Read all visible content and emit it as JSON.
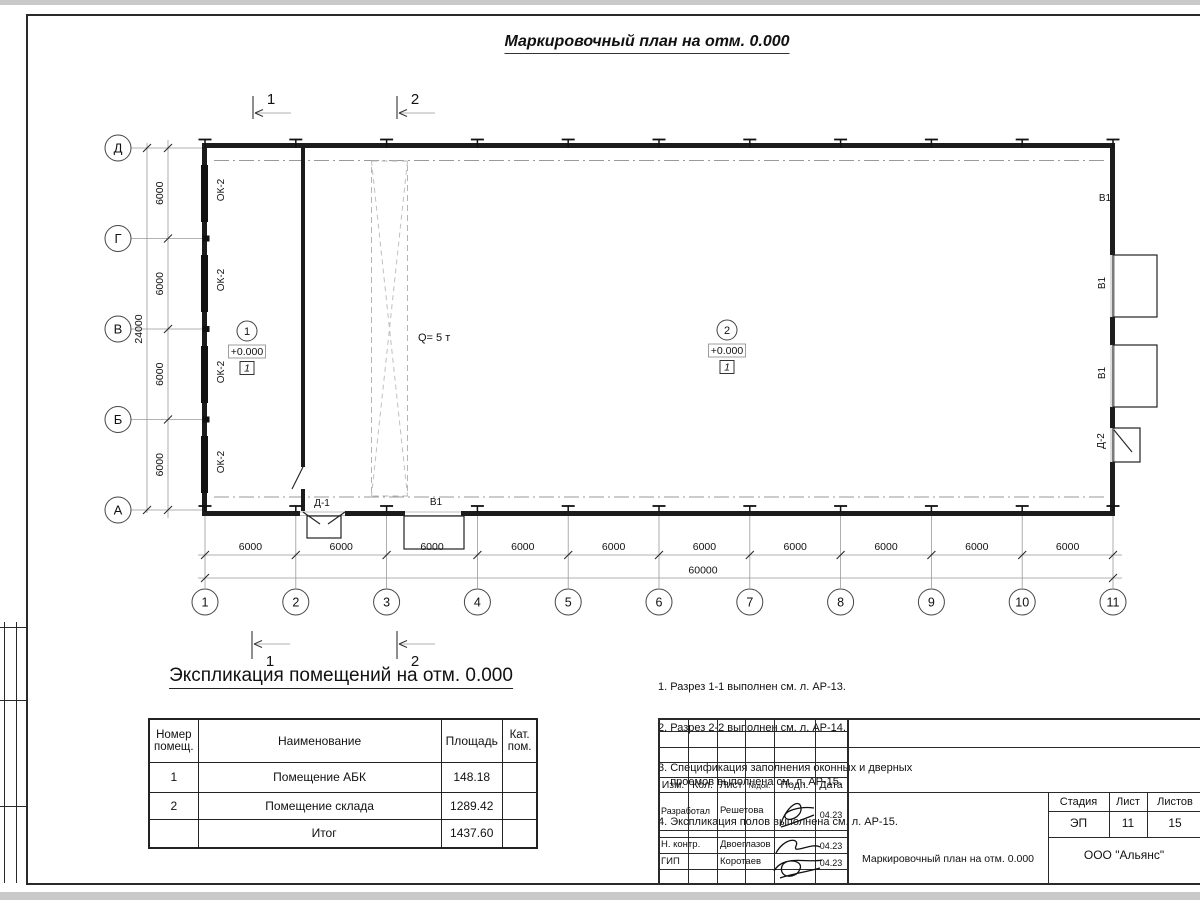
{
  "page": {
    "title": "Маркировочный план на отм. 0.000"
  },
  "plan": {
    "col_axes": [
      "1",
      "2",
      "3",
      "4",
      "5",
      "6",
      "7",
      "8",
      "9",
      "10",
      "11"
    ],
    "row_axes": [
      "Д",
      "Г",
      "В",
      "Б",
      "А"
    ],
    "bay_dim": "6000",
    "total_width": "60000",
    "total_height": "24000",
    "section_mark_1": "1",
    "section_mark_2": "2",
    "window_label": "ОК-2",
    "gate_label": "В1",
    "door1_label": "Д-1",
    "door2_label": "Д-2",
    "crane_label": "Q= 5 т",
    "room1": {
      "number": "1",
      "elevation": "+0.000",
      "floor_type": "1"
    },
    "room2": {
      "number": "2",
      "elevation": "+0.000",
      "floor_type": "1"
    }
  },
  "schedule": {
    "title": "Экспликация помещений на отм. 0.000",
    "headers": [
      "Номер помещ.",
      "Наименование",
      "Площадь",
      "Кат. пом."
    ],
    "rows": [
      [
        "1",
        "Помещение АБК",
        "148.18",
        ""
      ],
      [
        "2",
        "Помещение склада",
        "1289.42",
        ""
      ],
      [
        "",
        "Итог",
        "1437.60",
        ""
      ]
    ]
  },
  "notes": {
    "items": [
      "1. Разрез 1-1 выполнен см. л. АР-13.",
      "2. Разрез 2-2 выполнен см. л. АР-14.",
      "3. Спецификация заполнения оконных и дверных\n    проемов выполнена см. л. АР-15.",
      "4. Экспликация полов выполнена см. л. АР-15."
    ]
  },
  "titleblock": {
    "header_cols": [
      "Изм.",
      "Кол.",
      "Лист",
      "№док.",
      "Подп.",
      "Дата"
    ],
    "rows": [
      {
        "role": "Разработал",
        "name": "Решетова",
        "date": "04.23"
      },
      {
        "role": "Н. контр.",
        "name": "Двоеглазов",
        "date": "04.23"
      },
      {
        "role": "ГИП",
        "name": "Коротаев",
        "date": "04.23"
      }
    ],
    "stage_label": "Стадия",
    "sheet_label": "Лист",
    "sheets_label": "Листов",
    "stage": "ЭП",
    "sheet": "11",
    "sheets": "15",
    "doc_title": "Маркировочный план на отм. 0.000",
    "company": "ООО \"Альянс\""
  }
}
